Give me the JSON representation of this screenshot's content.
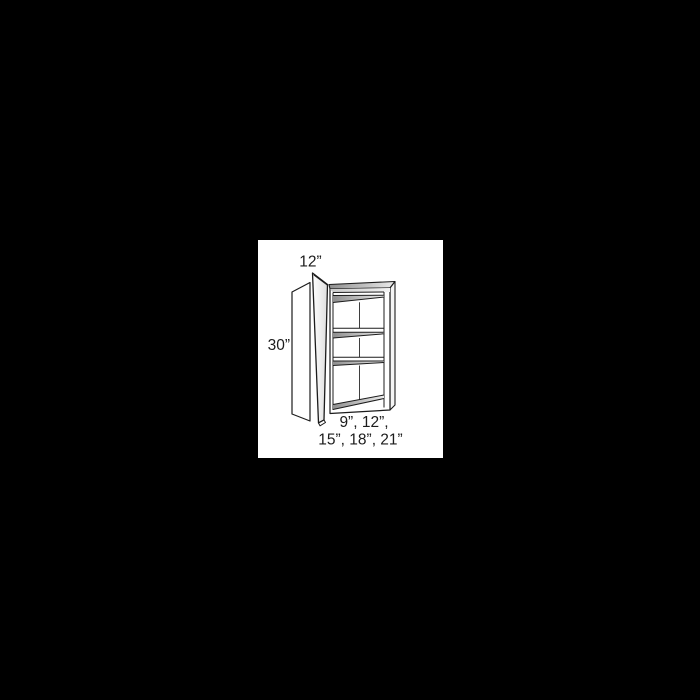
{
  "scene": {
    "background_color": "#000000",
    "panel_color": "#ffffff",
    "line_color": "#1c1c1c",
    "shade_dark": "#909090",
    "shade_light": "#ededed"
  },
  "diagram": {
    "subject": "wall-cabinet-dimension-drawing",
    "labels": {
      "top_width": "12”",
      "side_height": "30”",
      "bottom_widths_line1": "9”, 12”,",
      "bottom_widths_line2": "15”, 18”, 21”"
    }
  }
}
